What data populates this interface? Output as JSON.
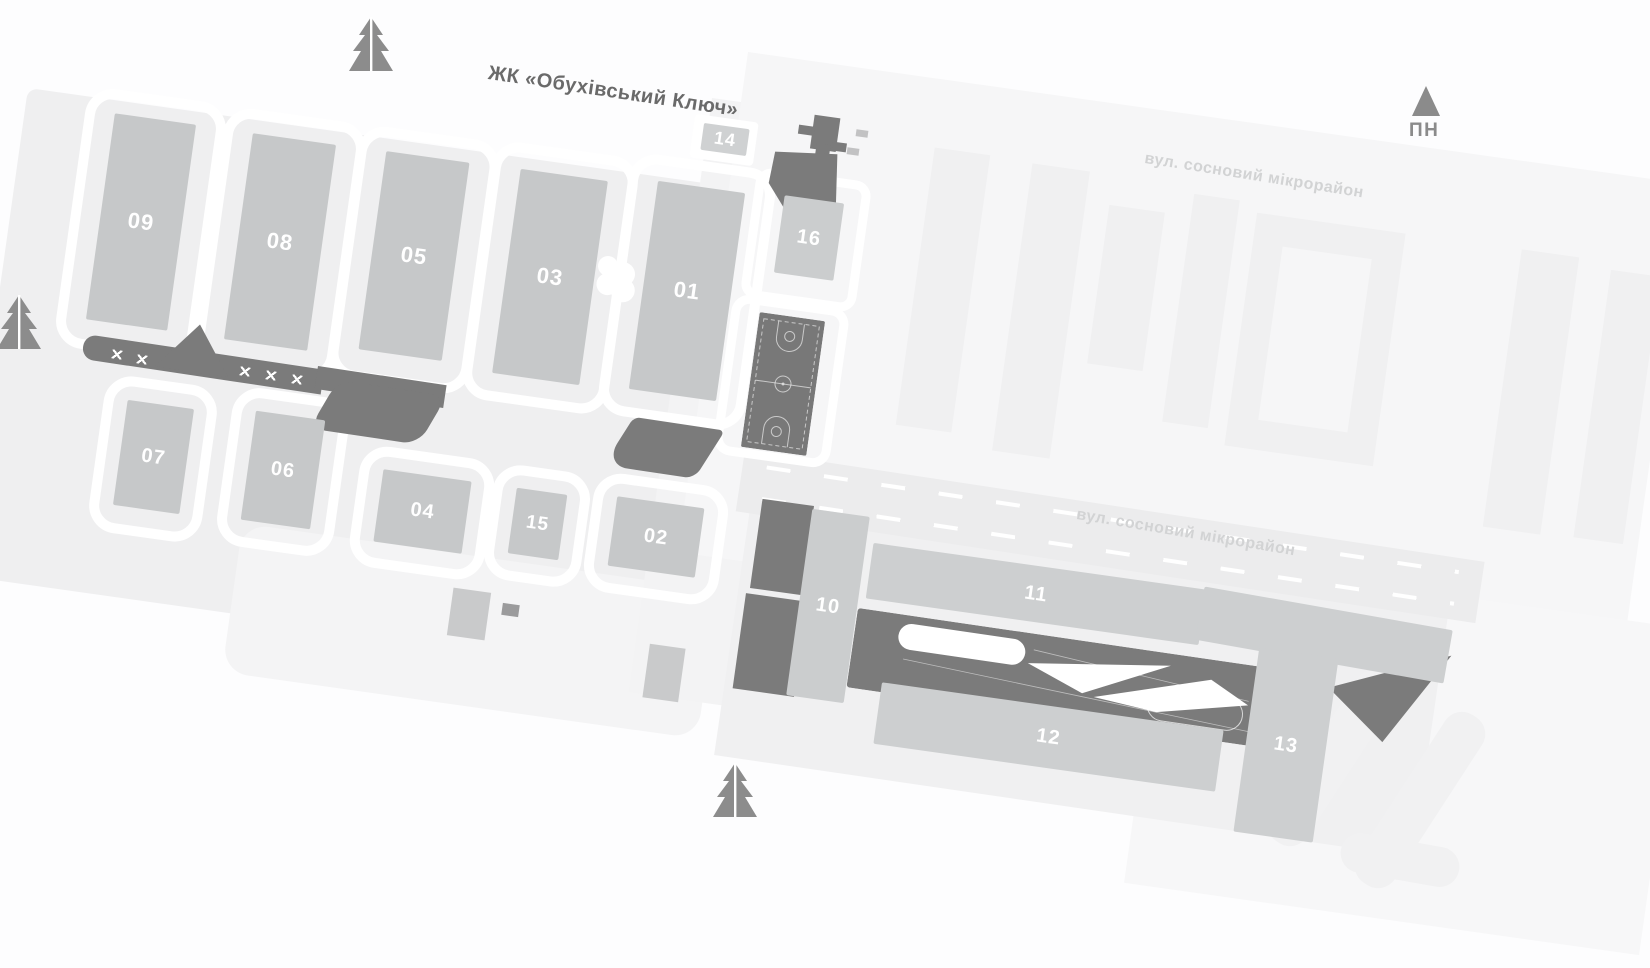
{
  "complex": {
    "title": "ЖК «Обухівський Ключ»"
  },
  "compass": {
    "label": "ПН"
  },
  "streets": {
    "north_label": "вул. сосновий мікрорайон",
    "south_label": "вул. сосновий мікрорайон"
  },
  "buildings": {
    "b01": "01",
    "b02": "02",
    "b03": "03",
    "b04": "04",
    "b05": "05",
    "b06": "06",
    "b07": "07",
    "b08": "08",
    "b09": "09",
    "b10": "10",
    "b11": "11",
    "b12": "12",
    "b13": "13",
    "b14": "14",
    "b15": "15",
    "b16": "16"
  },
  "icons": [
    "north-arrow-icon",
    "fir-tree-icon",
    "basketball-court-icon",
    "sports-field-icon",
    "key-structure-icon"
  ],
  "colors": {
    "background": "#fdfdfe",
    "site_plate": "#efeff0",
    "neighbor_plate": "#f6f6f7",
    "building_fill": "#c6c8c9",
    "building_number": "#ffffff",
    "dark_feature": "#7b7b7b",
    "icon_gray": "#8b8b8b",
    "street_text": "#d2d3d4",
    "title_text": "#6a6a6a"
  }
}
